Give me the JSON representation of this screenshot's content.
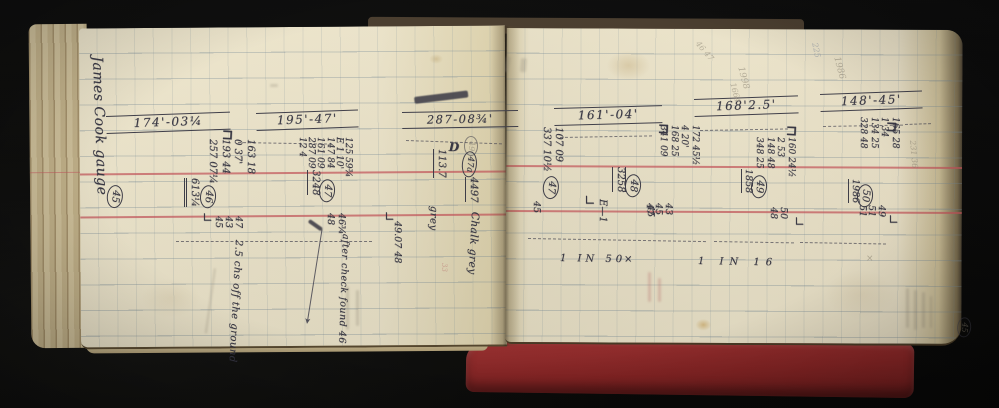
{
  "colors": {
    "paper": "#ebe3c9",
    "cover_red": "#8a2525",
    "ruling_red": "#c6545a",
    "ink": "#363541",
    "pencil": "#8b8372"
  },
  "book": {
    "left_page": {
      "annotations": [
        {
          "name": "margin-signature",
          "text": "James Cook gauge",
          "x": 104,
          "y": 56,
          "rot": 88,
          "fs": 14,
          "w": 178,
          "cls": "script ink"
        },
        {
          "name": "peg-45-circled",
          "text": "45",
          "x": 124,
          "y": 186,
          "rot": 96,
          "fs": 10,
          "cls": "ink circled"
        },
        {
          "name": "section-header-174",
          "text": "174'-03¼",
          "x": 106,
          "y": 116,
          "rot": -2,
          "fs": 12,
          "w": 108,
          "cls": "ink header"
        },
        {
          "name": "staple-mark",
          "text": "⊐",
          "x": 222,
          "y": 128,
          "rot": 3,
          "fs": 14,
          "cls": "ink bold"
        },
        {
          "name": "readings-46",
          "lines": [
            "163 18",
            "0 37'",
            "193 44",
            "257 07¼"
          ],
          "x": 256,
          "y": 139,
          "rot": 90,
          "fs": 10,
          "lh": 12.5,
          "cls": "ink"
        },
        {
          "name": "total-46",
          "text": "613¼",
          "x": 199,
          "y": 178,
          "rot": 90,
          "fs": 10,
          "cls": "ink u2"
        },
        {
          "name": "peg-46-circled",
          "text": "46",
          "x": 217,
          "y": 186,
          "rot": 95,
          "fs": 10,
          "cls": "ink circled"
        },
        {
          "name": "check-readings-46",
          "lines": [
            "47",
            "43",
            "45"
          ],
          "x": 243,
          "y": 216,
          "rot": 90,
          "fs": 9.5,
          "lh": 10,
          "cls": "ink"
        },
        {
          "name": "corner-mark",
          "text": "∟",
          "x": 202,
          "y": 212,
          "rot": 0,
          "fs": 13,
          "cls": "ink"
        },
        {
          "name": "note-off-ground",
          "text": "2.5 chs off the ground",
          "x": 243,
          "y": 240,
          "rot": 93,
          "fs": 10,
          "w": 96,
          "cls": "script ink"
        },
        {
          "name": "section-header-195",
          "text": "195'-47'",
          "x": 256,
          "y": 113,
          "rot": -2,
          "fs": 12,
          "w": 86,
          "cls": "ink header"
        },
        {
          "name": "readings-47",
          "lines": [
            "125 59¾",
            "E 1 10'",
            "147 84",
            "161 09",
            "287 09",
            "12 4"
          ],
          "x": 352,
          "y": 137,
          "rot": 90,
          "fs": 9,
          "lh": 9.2,
          "cls": "ink"
        },
        {
          "name": "total-47",
          "text": "3248",
          "x": 320,
          "y": 170,
          "rot": 90,
          "fs": 10,
          "cls": "ink u1"
        },
        {
          "name": "peg-47-circled",
          "text": "47",
          "x": 336,
          "y": 180,
          "rot": 95,
          "fs": 10,
          "cls": "ink circled"
        },
        {
          "name": "check-readings-47",
          "lines": [
            "46¾",
            "48"
          ],
          "x": 347,
          "y": 213,
          "rot": 90,
          "fs": 9.5,
          "lh": 11,
          "cls": "ink"
        },
        {
          "name": "note-after-check",
          "text": "after check found 46",
          "x": 350,
          "y": 234,
          "rot": 92,
          "fs": 9.5,
          "w": 90,
          "cls": "script ink"
        },
        {
          "name": "section-header-287",
          "text": "287-08¾'",
          "x": 402,
          "y": 112,
          "rot": -1,
          "fs": 11.5,
          "w": 100,
          "cls": "ink header"
        },
        {
          "name": "pencil-49-circled",
          "text": "49",
          "x": 478,
          "y": 136,
          "rot": 90,
          "fs": 8,
          "cls": "pencil faint circled"
        },
        {
          "name": "level-113-7",
          "text": "113.7",
          "x": 446,
          "y": 149,
          "rot": 90,
          "fs": 10,
          "cls": "ink u1"
        },
        {
          "name": "note-grey",
          "text": "grey",
          "x": 438,
          "y": 206,
          "rot": 92,
          "fs": 10,
          "cls": "script ink"
        },
        {
          "name": "peg-47a-circled",
          "text": "47a",
          "x": 478,
          "y": 152,
          "rot": 95,
          "fs": 8.5,
          "cls": "ink circled"
        },
        {
          "name": "total-4497",
          "text": "4497",
          "x": 478,
          "y": 177,
          "rot": 90,
          "fs": 10,
          "cls": "ink u1"
        },
        {
          "name": "note-chalk-grey",
          "text": "Chalk grey",
          "x": 480,
          "y": 212,
          "rot": 93,
          "fs": 10.5,
          "w": 88,
          "cls": "script ink"
        },
        {
          "name": "corner-mark",
          "text": "∟",
          "x": 384,
          "y": 211,
          "rot": 0,
          "fs": 13,
          "cls": "ink"
        },
        {
          "name": "readings-49-07",
          "text": "49.07 48",
          "x": 402,
          "y": 221,
          "rot": 90,
          "fs": 9.5,
          "cls": "ink"
        },
        {
          "name": "red-pencil-33",
          "text": "33",
          "x": 447,
          "y": 263,
          "rot": 90,
          "fs": 7,
          "cls": "redpencil faint"
        },
        {
          "name": "staple-mark",
          "text": "D",
          "x": 449,
          "y": 141,
          "rot": 2,
          "fs": 12,
          "cls": "ink bold"
        }
      ]
    },
    "right_page": {
      "annotations": [
        {
          "name": "section-header-161",
          "text": "161'-04'",
          "x": 554,
          "y": 108,
          "rot": -1.5,
          "fs": 12,
          "w": 92,
          "cls": "ink header"
        },
        {
          "name": "readings-47r",
          "lines": [
            "107 09",
            "337 10½"
          ],
          "x": 564,
          "y": 127,
          "rot": 90,
          "fs": 10,
          "lh": 12,
          "cls": "ink"
        },
        {
          "name": "peg-47-circled",
          "text": "47",
          "x": 560,
          "y": 177,
          "rot": 96,
          "fs": 10,
          "cls": "ink circled"
        },
        {
          "name": "check-45",
          "text": "45",
          "x": 541,
          "y": 201,
          "rot": 90,
          "fs": 9.5,
          "cls": "ink"
        },
        {
          "name": "corner-mark",
          "text": "∟",
          "x": 584,
          "y": 194,
          "rot": 0,
          "fs": 14,
          "cls": "ink"
        },
        {
          "name": "mark-e1",
          "text": "E—1",
          "x": 607,
          "y": 199,
          "rot": 90,
          "fs": 10,
          "cls": "ink"
        },
        {
          "name": "check-45",
          "text": "45",
          "x": 655,
          "y": 205,
          "rot": 90,
          "fs": 9.5,
          "cls": "ink"
        },
        {
          "name": "staple-mark",
          "text": "⊐",
          "x": 658,
          "y": 122,
          "rot": 3,
          "fs": 14,
          "cls": "ink bold"
        },
        {
          "name": "readings-48",
          "lines": [
            "172 45½",
            "4 20'",
            "168 25",
            "341 09"
          ],
          "x": 700,
          "y": 125,
          "rot": 90,
          "fs": 9,
          "lh": 10.5,
          "cls": "ink"
        },
        {
          "name": "peg-48-circled",
          "text": "48",
          "x": 642,
          "y": 175,
          "rot": 95,
          "fs": 10,
          "cls": "ink circled"
        },
        {
          "name": "total-3258",
          "text": "3258",
          "x": 626,
          "y": 167,
          "rot": 90,
          "fs": 10,
          "cls": "ink u1 o1"
        },
        {
          "name": "check-readings-48",
          "lines": [
            "43",
            "45",
            "47"
          ],
          "x": 673,
          "y": 203,
          "rot": 90,
          "fs": 9.5,
          "lh": 9.5,
          "cls": "ink"
        },
        {
          "name": "scale-1-in-50",
          "text": "1 IN 50",
          "x": 560,
          "y": 254,
          "rot": 1,
          "fs": 10,
          "cls": "ink spaced"
        },
        {
          "name": "x-mark",
          "text": "×",
          "x": 624,
          "y": 255,
          "rot": 0,
          "fs": 10,
          "cls": "ink"
        },
        {
          "name": "scale-1-in-16",
          "text": "1 IN 16",
          "x": 698,
          "y": 257,
          "rot": 1,
          "fs": 10,
          "cls": "ink spaced2"
        },
        {
          "name": "section-header-168",
          "text": "168'2.5'",
          "x": 694,
          "y": 99,
          "rot": -2,
          "fs": 12,
          "w": 88,
          "cls": "ink header"
        },
        {
          "name": "pencil-1998",
          "text": "1998",
          "x": 744,
          "y": 66,
          "rot": 75,
          "fs": 9,
          "cls": "pencil faint"
        },
        {
          "name": "pencil-1664",
          "text": "1664",
          "x": 736,
          "y": 82,
          "rot": 75,
          "fs": 8,
          "cls": "pencil faint"
        },
        {
          "name": "pencil-4647",
          "text": "46 47",
          "x": 700,
          "y": 40,
          "rot": 50,
          "fs": 8,
          "cls": "pencil faint"
        },
        {
          "name": "pencil-225",
          "text": "225",
          "x": 818,
          "y": 42,
          "rot": 78,
          "fs": 8,
          "cls": "bluepencil faint"
        },
        {
          "name": "pencil-1986",
          "text": "1986",
          "x": 840,
          "y": 56,
          "rot": 75,
          "fs": 9,
          "cls": "pencil faint"
        },
        {
          "name": "readings-49",
          "lines": [
            "160 24½",
            "2 53",
            "148 48",
            "348 25"
          ],
          "x": 796,
          "y": 137,
          "rot": 90,
          "fs": 9,
          "lh": 10.5,
          "cls": "ink"
        },
        {
          "name": "peg-49-circled",
          "text": "49",
          "x": 768,
          "y": 176,
          "rot": 95,
          "fs": 10,
          "cls": "ink circled"
        },
        {
          "name": "total-1858",
          "text": "1858",
          "x": 753,
          "y": 169,
          "rot": 90,
          "fs": 9.5,
          "cls": "ink u1"
        },
        {
          "name": "check-readings-49",
          "lines": [
            "50",
            "48"
          ],
          "x": 788,
          "y": 207,
          "rot": 90,
          "fs": 9.5,
          "lh": 10,
          "cls": "ink"
        },
        {
          "name": "corner-mark",
          "text": "∟",
          "x": 794,
          "y": 216,
          "rot": 0,
          "fs": 13,
          "cls": "ink"
        },
        {
          "name": "staple-mark",
          "text": "⊐",
          "x": 786,
          "y": 124,
          "rot": 3,
          "fs": 14,
          "cls": "ink bold"
        },
        {
          "name": "section-header-148",
          "text": "148'-45'",
          "x": 820,
          "y": 94,
          "rot": -2,
          "fs": 12,
          "w": 86,
          "cls": "ink header"
        },
        {
          "name": "staple-mark",
          "text": "⊐",
          "x": 886,
          "y": 120,
          "rot": 3,
          "fs": 14,
          "cls": "ink bold"
        },
        {
          "name": "readings-50",
          "lines": [
            "165 28",
            "1 34",
            "134 25",
            "328 48"
          ],
          "x": 900,
          "y": 117,
          "rot": 90,
          "fs": 9,
          "lh": 10.5,
          "cls": "ink"
        },
        {
          "name": "peg-50-circled",
          "text": "50",
          "x": 874,
          "y": 185,
          "rot": 95,
          "fs": 10,
          "cls": "ink circled"
        },
        {
          "name": "total-1986",
          "text": "1986",
          "x": 860,
          "y": 179,
          "rot": 90,
          "fs": 9.5,
          "cls": "ink u1"
        },
        {
          "name": "check-readings-50",
          "lines": [
            "49",
            "51",
            "51"
          ],
          "x": 886,
          "y": 205,
          "rot": 90,
          "fs": 9.5,
          "lh": 9.5,
          "cls": "ink"
        },
        {
          "name": "corner-mark",
          "text": "∟",
          "x": 888,
          "y": 214,
          "rot": 0,
          "fs": 13,
          "cls": "ink"
        },
        {
          "name": "pencil-231-36",
          "text": "231 36",
          "x": 916,
          "y": 140,
          "rot": 85,
          "fs": 8,
          "cls": "pencil faint"
        },
        {
          "name": "pencil-45-circled",
          "text": "45",
          "x": 972,
          "y": 318,
          "rot": 95,
          "fs": 8,
          "cls": "pencil faint circled"
        },
        {
          "name": "pencil-x",
          "text": "×",
          "x": 866,
          "y": 255,
          "rot": 0,
          "fs": 9,
          "cls": "pencil faint"
        }
      ]
    },
    "hand_lines": [
      {
        "name": "dash-under-174",
        "x": 238,
        "y": 142,
        "len": 94,
        "rot": 1,
        "style": "dash"
      },
      {
        "name": "dash-under-287",
        "x": 406,
        "y": 140,
        "len": 96,
        "rot": 2,
        "style": "dash"
      },
      {
        "name": "dash-under-161",
        "x": 560,
        "y": 137,
        "len": 92,
        "rot": -1,
        "style": "dash"
      },
      {
        "name": "dash-under-168",
        "x": 700,
        "y": 130,
        "len": 88,
        "rot": -1,
        "style": "dash"
      },
      {
        "name": "dash-under-148",
        "x": 823,
        "y": 126,
        "len": 80,
        "rot": -1,
        "style": "dash"
      },
      {
        "name": "dash-lower-left",
        "x": 176,
        "y": 241,
        "len": 196,
        "rot": 0,
        "style": "dash"
      },
      {
        "name": "dash-lower-right-a",
        "x": 528,
        "y": 238,
        "len": 178,
        "rot": 1,
        "style": "dash"
      },
      {
        "name": "dash-lower-right-b",
        "x": 714,
        "y": 241,
        "len": 80,
        "rot": 1,
        "style": "dash"
      },
      {
        "name": "dash-lower-right-c",
        "x": 800,
        "y": 242,
        "len": 86,
        "rot": 1,
        "style": "dash"
      },
      {
        "name": "dash-right-edge",
        "x": 905,
        "y": 124,
        "len": 26,
        "rot": -2,
        "style": "dash"
      },
      {
        "name": "arrow-line",
        "x": 322,
        "y": 229,
        "len": 92,
        "rot": 99,
        "style": "arrow",
        "tip": "➤"
      }
    ],
    "smudges": [
      {
        "name": "scratched-out-text",
        "x": 414,
        "y": 97,
        "w": 54,
        "h": 7,
        "rot": -7,
        "cls": "inksmudge"
      },
      {
        "name": "pencil-smudge",
        "x": 214,
        "y": 268,
        "w": 2,
        "h": 66,
        "rot": 8,
        "cls": ""
      },
      {
        "name": "pencil-smudge",
        "x": 346,
        "y": 286,
        "w": 3,
        "h": 44,
        "rot": 0,
        "cls": ""
      },
      {
        "name": "pencil-smudge",
        "x": 356,
        "y": 290,
        "w": 3,
        "h": 36,
        "rot": 0,
        "cls": ""
      },
      {
        "name": "red-pencil-smudge",
        "x": 648,
        "y": 272,
        "w": 3,
        "h": 30,
        "rot": 0,
        "cls": "redsmudge"
      },
      {
        "name": "red-pencil-smudge",
        "x": 658,
        "y": 278,
        "w": 3,
        "h": 24,
        "rot": 0,
        "cls": "redsmudge"
      },
      {
        "name": "pencil-smudge",
        "x": 906,
        "y": 288,
        "w": 3,
        "h": 40,
        "rot": 0,
        "cls": ""
      },
      {
        "name": "pencil-smudge",
        "x": 914,
        "y": 290,
        "w": 3,
        "h": 40,
        "rot": 0,
        "cls": ""
      },
      {
        "name": "pencil-smudge",
        "x": 922,
        "y": 292,
        "w": 3,
        "h": 36,
        "rot": 0,
        "cls": ""
      },
      {
        "name": "pencil-smudge",
        "x": 930,
        "y": 296,
        "w": 2,
        "h": 32,
        "rot": 0,
        "cls": ""
      },
      {
        "name": "pencil-smudge",
        "x": 270,
        "y": 84,
        "w": 8,
        "h": 3,
        "rot": 0,
        "cls": ""
      },
      {
        "name": "pencil-smudge",
        "x": 506,
        "y": 56,
        "w": 5,
        "h": 16,
        "rot": 10,
        "cls": ""
      },
      {
        "name": "pencil-smudge",
        "x": 521,
        "y": 58,
        "w": 6,
        "h": 14,
        "rot": 5,
        "cls": ""
      },
      {
        "name": "ink-squiggle",
        "x": 310,
        "y": 219,
        "w": 16,
        "h": 4,
        "rot": 35,
        "cls": "inksmudge"
      }
    ]
  }
}
